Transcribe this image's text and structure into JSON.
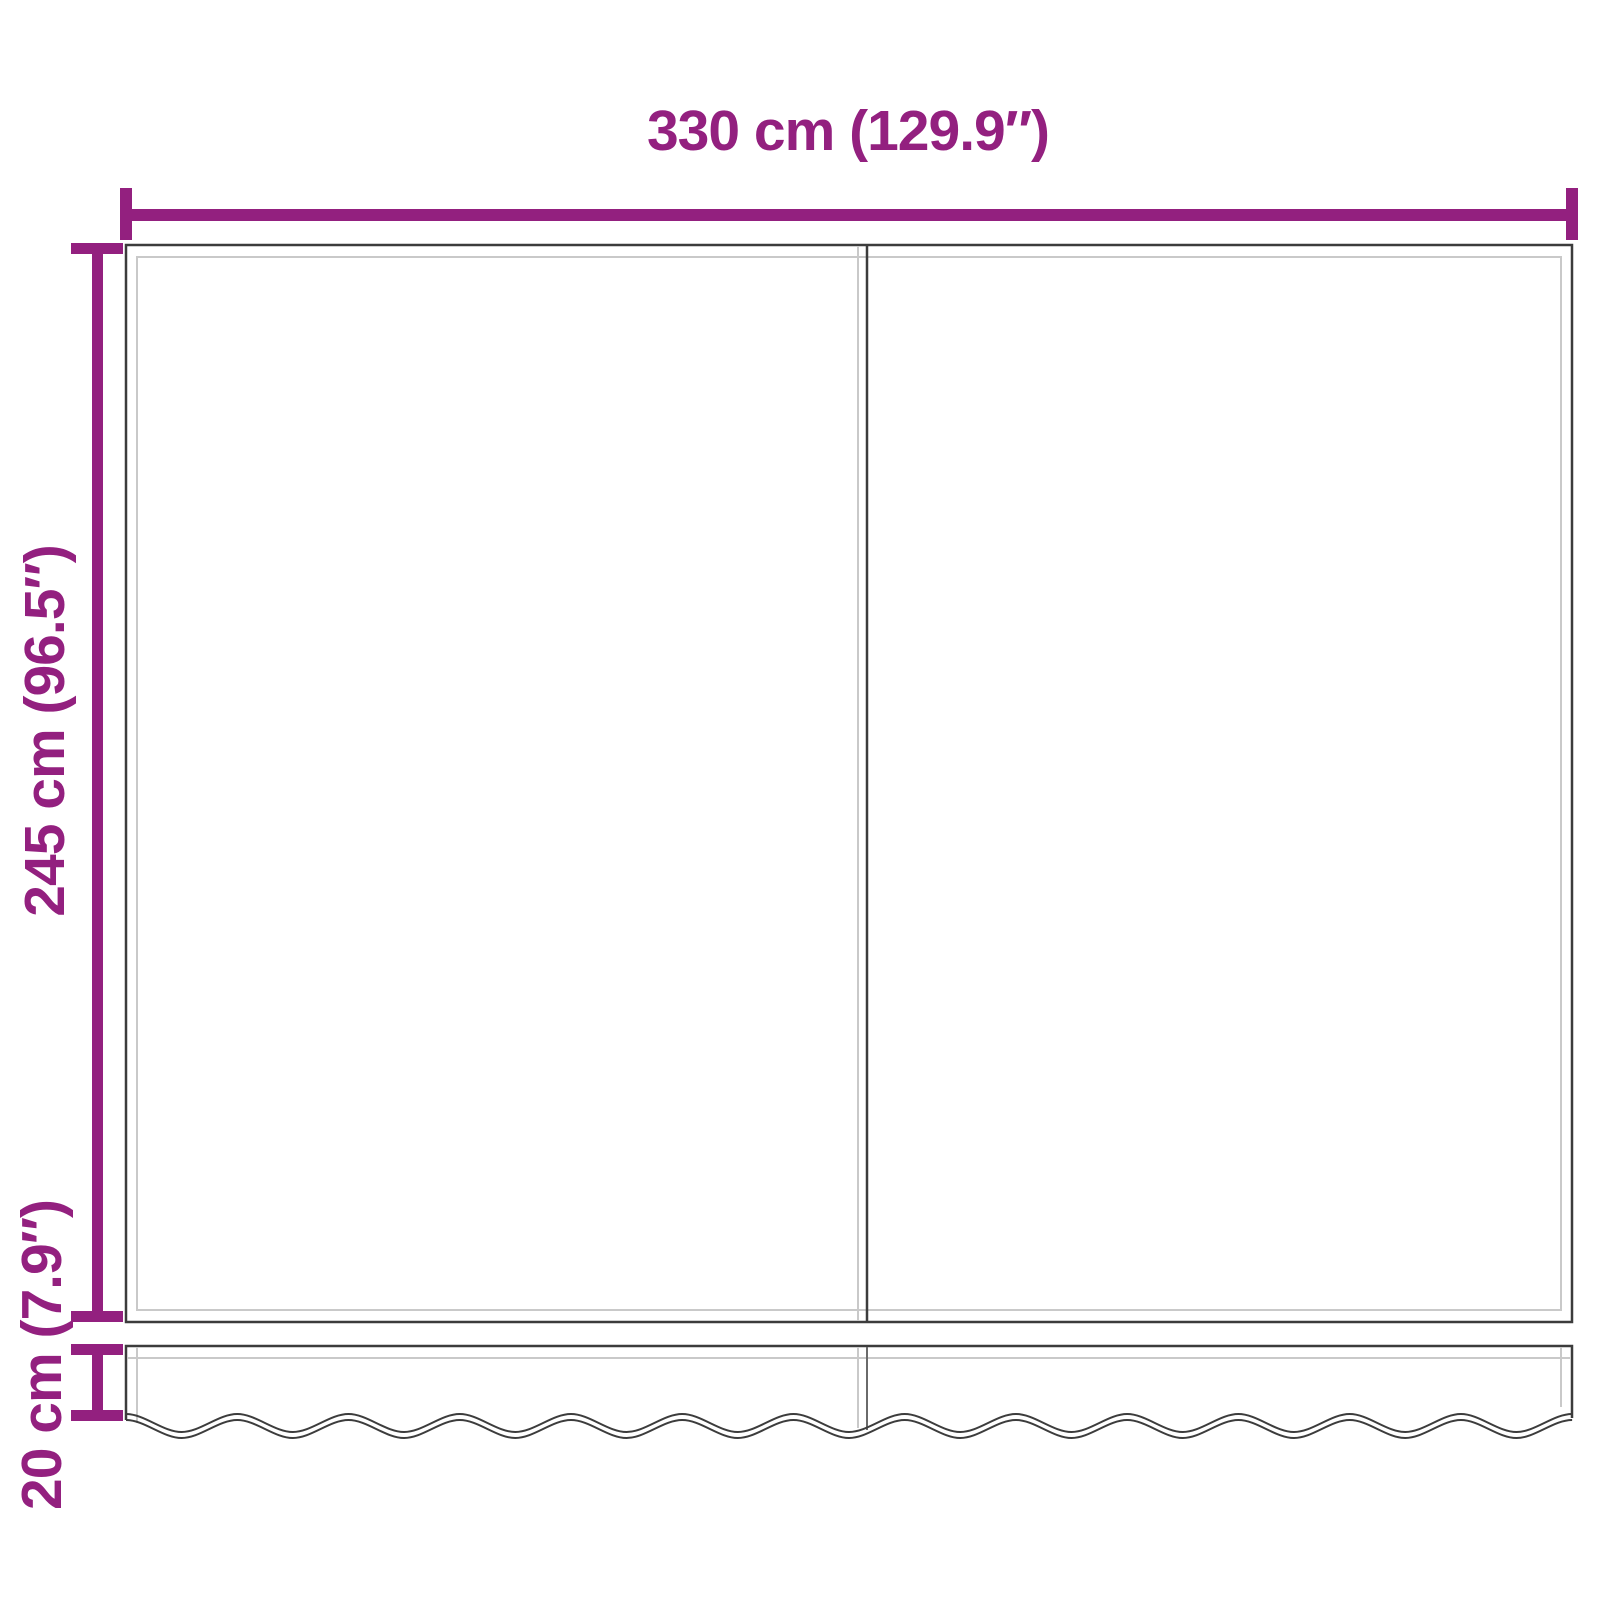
{
  "dimension_labels": {
    "width": "330 cm (129.9″)",
    "height": "245 cm (96.5″)",
    "valance_height": "20 cm (7.9″)"
  },
  "colors": {
    "dimension": "#93207f",
    "outline_dark": "#3c3c3c",
    "outline_mid": "#6a6a6a",
    "outline_light": "#c9c9c9",
    "background": "#ffffff"
  }
}
